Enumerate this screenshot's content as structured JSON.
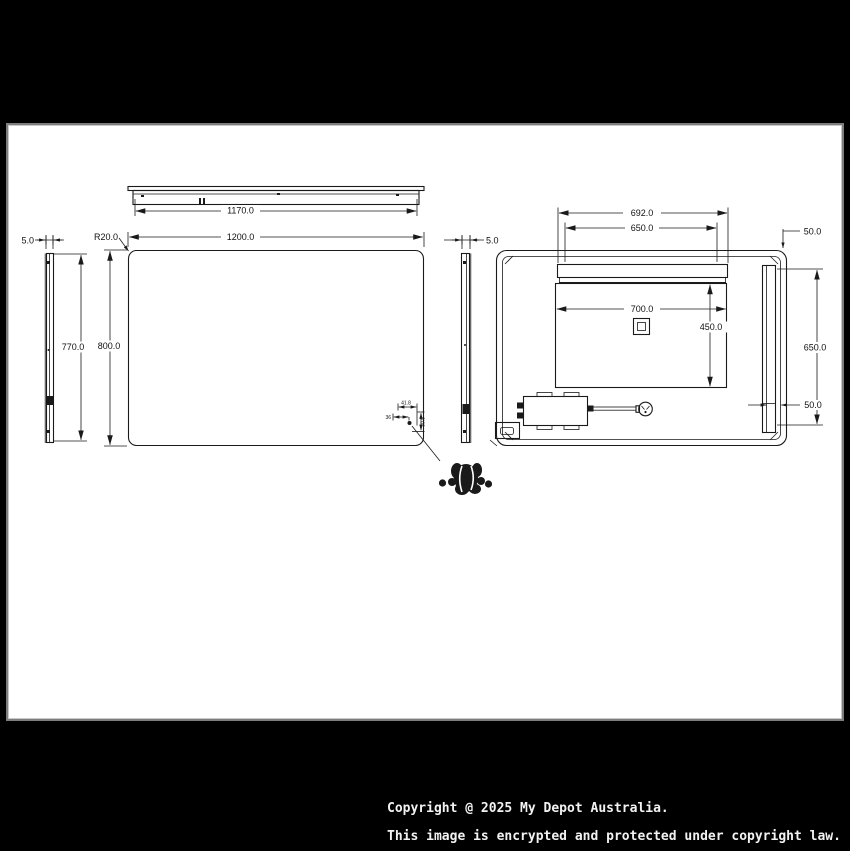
{
  "page": {
    "background": "#000000",
    "panel_background": "#ffffff",
    "line_color": "#1a1a1a"
  },
  "copyright": {
    "line1": "Copyright @ 2025 My Depot Australia.",
    "line2": "This image is encrypted and protected under copyright law."
  },
  "views": {
    "top_view": {
      "width_dim": "1170.0"
    },
    "front_view": {
      "width_dim": "1200.0",
      "height_dim": "800.0",
      "corner_radius_dim": "R20.0"
    },
    "side_view_left": {
      "thickness_dim": "5.0",
      "height_dim": "770.0"
    },
    "sensor_detail": {
      "offset_x_dim": "41.8",
      "offset_left_dim": "36",
      "offset_y_dim": "30.8"
    },
    "side_view_right": {
      "thickness_dim": "5.0"
    },
    "back_view": {
      "hanger_outer_dim": "692.0",
      "hanger_inner_dim": "650.0",
      "top_offset_dim": "50.0",
      "demister_width_dim": "700.0",
      "demister_height_dim": "450.0",
      "rail_height_dim": "650.0",
      "rail_offset_dim": "50.0"
    }
  }
}
